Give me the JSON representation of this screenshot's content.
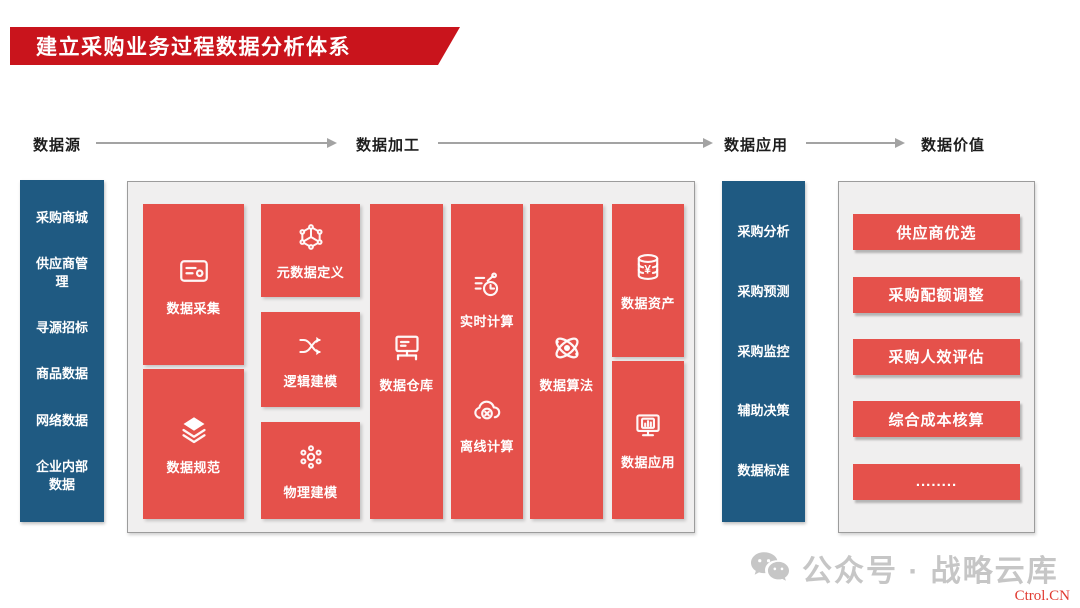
{
  "title": {
    "text": "建立采购业务过程数据分析体系"
  },
  "flow": {
    "steps": [
      {
        "label": "数据源"
      },
      {
        "label": "数据加工"
      },
      {
        "label": "数据应用"
      },
      {
        "label": "数据价值"
      }
    ]
  },
  "sources": {
    "items": [
      "采购商城",
      "供应商管理",
      "寻源招标",
      "商品数据",
      "网络数据",
      "企业内部数据"
    ]
  },
  "processing": {
    "col1": {
      "block1": {
        "icon": "id-card-icon",
        "label": "数据采集"
      },
      "block2": {
        "icon": "layers-icon",
        "label": "数据规范"
      }
    },
    "col2": {
      "block1": {
        "icon": "cube-network-icon",
        "label": "元数据定义"
      },
      "block2": {
        "icon": "shuffle-icon",
        "label": "逻辑建模"
      },
      "block3": {
        "icon": "molecule-icon",
        "label": "物理建模"
      }
    },
    "col3": {
      "block1": {
        "icon": "monitor-network-icon",
        "label": "数据仓库"
      }
    },
    "col4": {
      "item1": {
        "icon": "gauge-clock-icon",
        "label": "实时计算"
      },
      "item2": {
        "icon": "cloud-x-icon",
        "label": "离线计算"
      }
    },
    "col5": {
      "block1": {
        "icon": "atom-icon",
        "label": "数据算法"
      }
    },
    "col6": {
      "block1": {
        "icon": "coins-yen-icon",
        "label": "数据资产"
      },
      "block2": {
        "icon": "monitor-chart-icon",
        "label": "数据应用"
      }
    }
  },
  "applications": {
    "items": [
      "采购分析",
      "采购预测",
      "采购监控",
      "辅助决策",
      "数据标准"
    ]
  },
  "values": {
    "items": [
      "供应商优选",
      "采购配额调整",
      "采购人效评估",
      "综合成本核算",
      "........"
    ]
  },
  "footer": {
    "wechat_label": "公众号 · 战略云库",
    "watermark": "Ctrol.CN"
  },
  "colors": {
    "banner_red": "#c9141c",
    "block_red": "#e5514b",
    "panel_blue": "#1f5a82",
    "panel_bg": "#f0efef",
    "arrow_gray": "#a3a3a3"
  }
}
